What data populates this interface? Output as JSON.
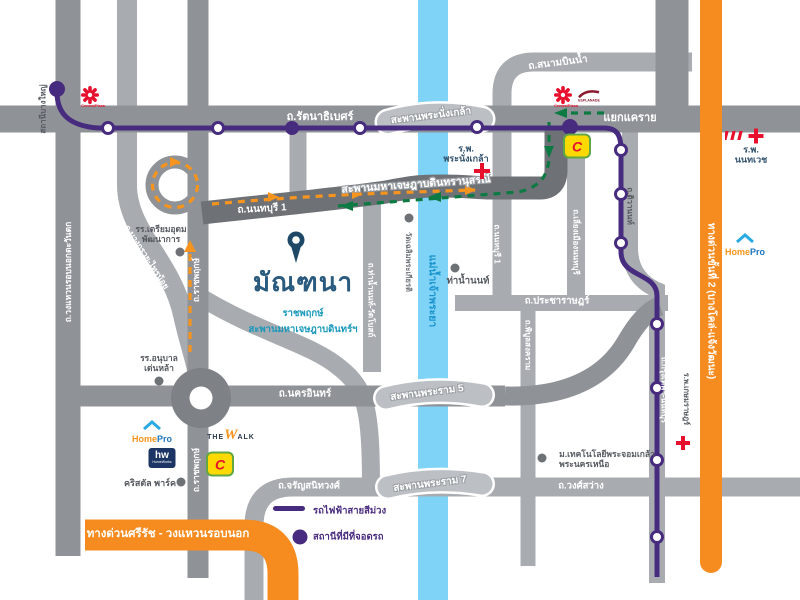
{
  "colors": {
    "road-light": "#a8acb1",
    "road-mid": "#8f9398",
    "road-dark": "#6e7276",
    "bridge": "#bcc0c5",
    "river": "#7ed3f7",
    "purple": "#472b7e",
    "exp-orange": "#f68b1f",
    "arrow-orange": "#f7941d",
    "arrow-green": "#0e7a43",
    "red": "#e8112d"
  },
  "project": {
    "name": "มัณฑนา",
    "sub1": "ราชพฤกษ์",
    "sub2": "สะพานมหาเจษฎาบดินทร์ฯ"
  },
  "roads": {
    "rattanathibet": "ถ.รัตนาธิเบศร์",
    "khae_rai": "แยกแคราย",
    "sanambin_nam": "ถ.สนามบินน้ำ",
    "outer_ring": "ถ.วงแหวนรอบนอกตะวันตก",
    "ratchaphruek": "ถ.ราชพฤกษ์",
    "bang_kruai_sai_noi": "ถ.บางกรวย-ไทรน้อย",
    "nonthaburi1": "ถ.นนทบุรี 1",
    "tiwanon": "ถ.ติวานนท์",
    "liang_mueang": "ถ.เลี่ยงเมืองนนทบุรี",
    "pracharat": "ถ.ประชาราษฎร์",
    "phibun_songkhram": "ถ.พิบูลสงคราม",
    "tha_nam_non_wat_bot": "ถ.ท่าน้ำนนท์-วัดโบสถ์",
    "nakhon_in": "ถ.นครอินทร์",
    "charan": "ถ.จรัญสนิทวงศ์",
    "wong_sawang": "ถ.วงศ์สว่าง",
    "krungthep_nonthaburi": "ถ.กรุงเทพฯ-นนทบุรี"
  },
  "bridges": {
    "phra_nangklao": "สะพานพระนั่งเกล้า",
    "chesadabodin": "สะพานมหาเจษฎาบดินทรานุสรณ์",
    "rama5": "สะพานพระราม 5",
    "rama7": "สะพานพระราม 7"
  },
  "river": {
    "name": "แม่น้ำเจ้าพระยา"
  },
  "expressways": {
    "si_rat": "ทางด่วนศรีรัช - วงแหวนรอบนอก",
    "stage2": "ทางด่วนขั้นที่ 2 (บางโคล่-แจ้งวัฒนะ)"
  },
  "stations": {
    "bang_yai": "สถานีบางใหญ่"
  },
  "places": {
    "school_triam": {
      "line1": "รร.เตรียมอุดม",
      "line2": "พัฒนาการ"
    },
    "school_denla": {
      "line1": "รร.อนุบาล",
      "line2": "เด่นหล้า"
    },
    "wat_chaloem": "วัดเฉลิมพระเกียรติ",
    "tha_nam_non": "ท่าน้ำนนท์",
    "crystal_park": "คริสตัล พาร์ค",
    "univ": {
      "line1": "ม.เทคโนโลยีพระจอมเกล้า",
      "line2": "พระนครเหนือ"
    },
    "hospital_phra_nangklao": {
      "line1": "ร.พ.",
      "line2": "พระนั่งเกล้า"
    },
    "hospital_nonthavej": {
      "line1": "ร.พ.",
      "line2": "นนทเวช"
    },
    "hospital_kasemrad": "ร.พ.เกษมราษฎร์"
  },
  "brands": {
    "central": "CentralPlaza",
    "esplanade": "ESPLANADE",
    "big_c": "C",
    "homepro_home": "Home",
    "homepro_pro": "Pro",
    "homeworks_mark": "hw",
    "homeworks_name": "HomeWorks",
    "thewalk_the": "THE",
    "thewalk_w": "W",
    "thewalk_alk": "ALK"
  },
  "legend": {
    "purple_line": "รถไฟฟ้าสายสีม่วง",
    "parking_station": "สถานีที่มีที่จอดรถ"
  }
}
